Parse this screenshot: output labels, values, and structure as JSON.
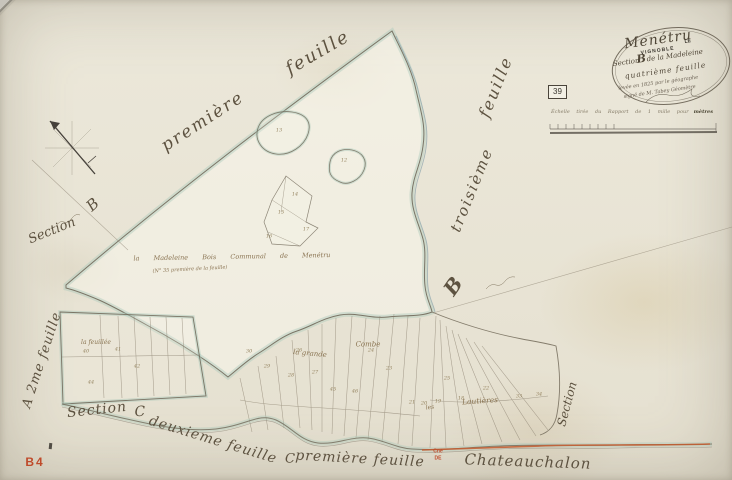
{
  "colors": {
    "paper": "#ebe7d9",
    "ink": "#5d5240",
    "wash_teal": "#a9c8ba",
    "stream_blue": "#8fa6ad",
    "road_red": "#c65a2e",
    "stamp_red": "#bf4a2a"
  },
  "map": {
    "sheet_ref_red": "B4",
    "edge_labels": {
      "top_feuille": "feuille",
      "premiere": "première",
      "right_feuille": "feuille",
      "troisieme": "troisième",
      "right_B": "B",
      "left_B": "B",
      "left_section": "Section",
      "a_2me_feuille": "A 2me feuille",
      "section_c_word": "Section",
      "section_c_letter": "C",
      "deuxieme_feuille": "deuxieme feuille",
      "bottom_c": "C",
      "bottom_premiere_feuille": "première feuille",
      "cne_line1": "Cne",
      "cne_line2": "DE",
      "chateauchalon": "Chateauchalon",
      "right_section_vertical": "Section"
    },
    "interior_labels": {
      "bois_line": "la Madeleine Bois Communal de Menétru",
      "bois_subline": "(N° 35 première de la feuille)",
      "la_feuillee": "la feuillée",
      "la_grande": "la grande",
      "combe": "Combe",
      "les": "les",
      "lautieres": "Lautières"
    },
    "parcel_numbers": [
      {
        "t": "13",
        "x": 279,
        "y": 131
      },
      {
        "t": "12",
        "x": 344,
        "y": 161
      },
      {
        "t": "14",
        "x": 295,
        "y": 195
      },
      {
        "t": "15",
        "x": 281,
        "y": 213
      },
      {
        "t": "16",
        "x": 269,
        "y": 237
      },
      {
        "t": "17",
        "x": 306,
        "y": 230
      },
      {
        "t": "40",
        "x": 86,
        "y": 352
      },
      {
        "t": "41",
        "x": 118,
        "y": 350
      },
      {
        "t": "42",
        "x": 137,
        "y": 367
      },
      {
        "t": "44",
        "x": 91,
        "y": 383
      },
      {
        "t": "30",
        "x": 249,
        "y": 352
      },
      {
        "t": "29",
        "x": 267,
        "y": 367
      },
      {
        "t": "28",
        "x": 291,
        "y": 376
      },
      {
        "t": "27",
        "x": 315,
        "y": 373
      },
      {
        "t": "26",
        "x": 299,
        "y": 351
      },
      {
        "t": "24",
        "x": 371,
        "y": 351
      },
      {
        "t": "23",
        "x": 389,
        "y": 369
      },
      {
        "t": "25",
        "x": 447,
        "y": 379
      },
      {
        "t": "22",
        "x": 486,
        "y": 389
      },
      {
        "t": "21",
        "x": 412,
        "y": 403
      },
      {
        "t": "20",
        "x": 424,
        "y": 404
      },
      {
        "t": "19",
        "x": 438,
        "y": 402
      },
      {
        "t": "18",
        "x": 461,
        "y": 399
      },
      {
        "t": "33",
        "x": 519,
        "y": 397
      },
      {
        "t": "34",
        "x": 539,
        "y": 395
      },
      {
        "t": "45",
        "x": 333,
        "y": 390
      },
      {
        "t": "46",
        "x": 355,
        "y": 392
      }
    ]
  },
  "cartouche": {
    "title": "Menétru",
    "stamp_le": "LE",
    "stamp_vignoble": "VIGNOBLE",
    "section_word": "Section",
    "section_letter": "B",
    "section_rest": "de la Madeleine",
    "feuille_line": "quatrième feuille",
    "detail_line1": "levée en 1825 par le géographe",
    "detail_line2": "signé de M. Tabey Géomètre",
    "sheet_number": "39"
  },
  "scale": {
    "caption": "Échelle tirée du Rapport de 1 mille pour",
    "caption_end": "mètres"
  }
}
